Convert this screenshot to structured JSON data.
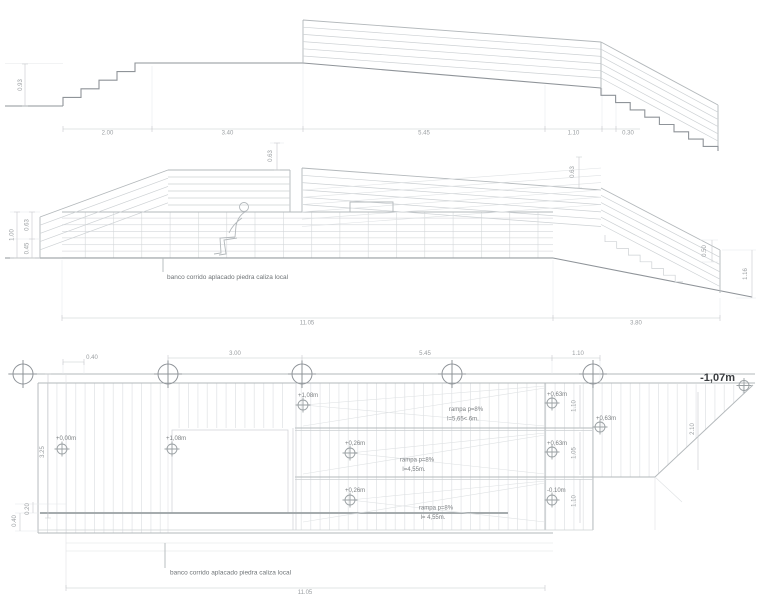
{
  "drawing": {
    "top_section": {
      "dims": {
        "height_left": "0.93",
        "w_stairs": "2.00",
        "w_plateau": "3.40",
        "w_ramp": "5.45",
        "w_landing": "1.10",
        "w_steps": "0.30"
      }
    },
    "mid_section": {
      "dims": {
        "left_total": "1.00",
        "left_upper": "0.63",
        "left_lower": "0.45",
        "peak_parapet": "0.63",
        "right_parapet": "0.63",
        "right_step": "0.50",
        "right_drop": "1.16",
        "bottom_main": "11.05",
        "bottom_stairs": "3.80"
      },
      "note": "banco corrido aplacado piedra caliza local"
    },
    "plan": {
      "dims": {
        "top_1": "0.40",
        "top_2": "3.00",
        "top_3": "5.45",
        "top_4": "1.10",
        "left_1": "3.25",
        "left_2": "0.20",
        "left_3": "0.40",
        "right_band1": "1.10",
        "right_band2": "1.05",
        "right_band3": "1.10",
        "triangle": "2.10",
        "bottom": "11.05"
      },
      "levels": {
        "entry": "+0,00m",
        "platform_left": "+1,08m",
        "ramp1_start": "+1,08m",
        "ramp1_end": "+0,63m",
        "ramp2_start": "+0,26m",
        "ramp2_end": "+0,63m",
        "ramp3_start": "+0,26m",
        "ramp3_end": "-0.10m",
        "landing_mid": "+0,63m",
        "street": "-1,07m"
      },
      "ramps": [
        {
          "line1": "rampa p=8%",
          "line2": "l=5,65< 6m."
        },
        {
          "line1": "rampa p=8%",
          "line2": "l=4,55m."
        },
        {
          "line1": "rampa p=8%",
          "line2": "l= 4,55m."
        }
      ],
      "note": "banco corrido aplacado piedra caliza local"
    }
  }
}
